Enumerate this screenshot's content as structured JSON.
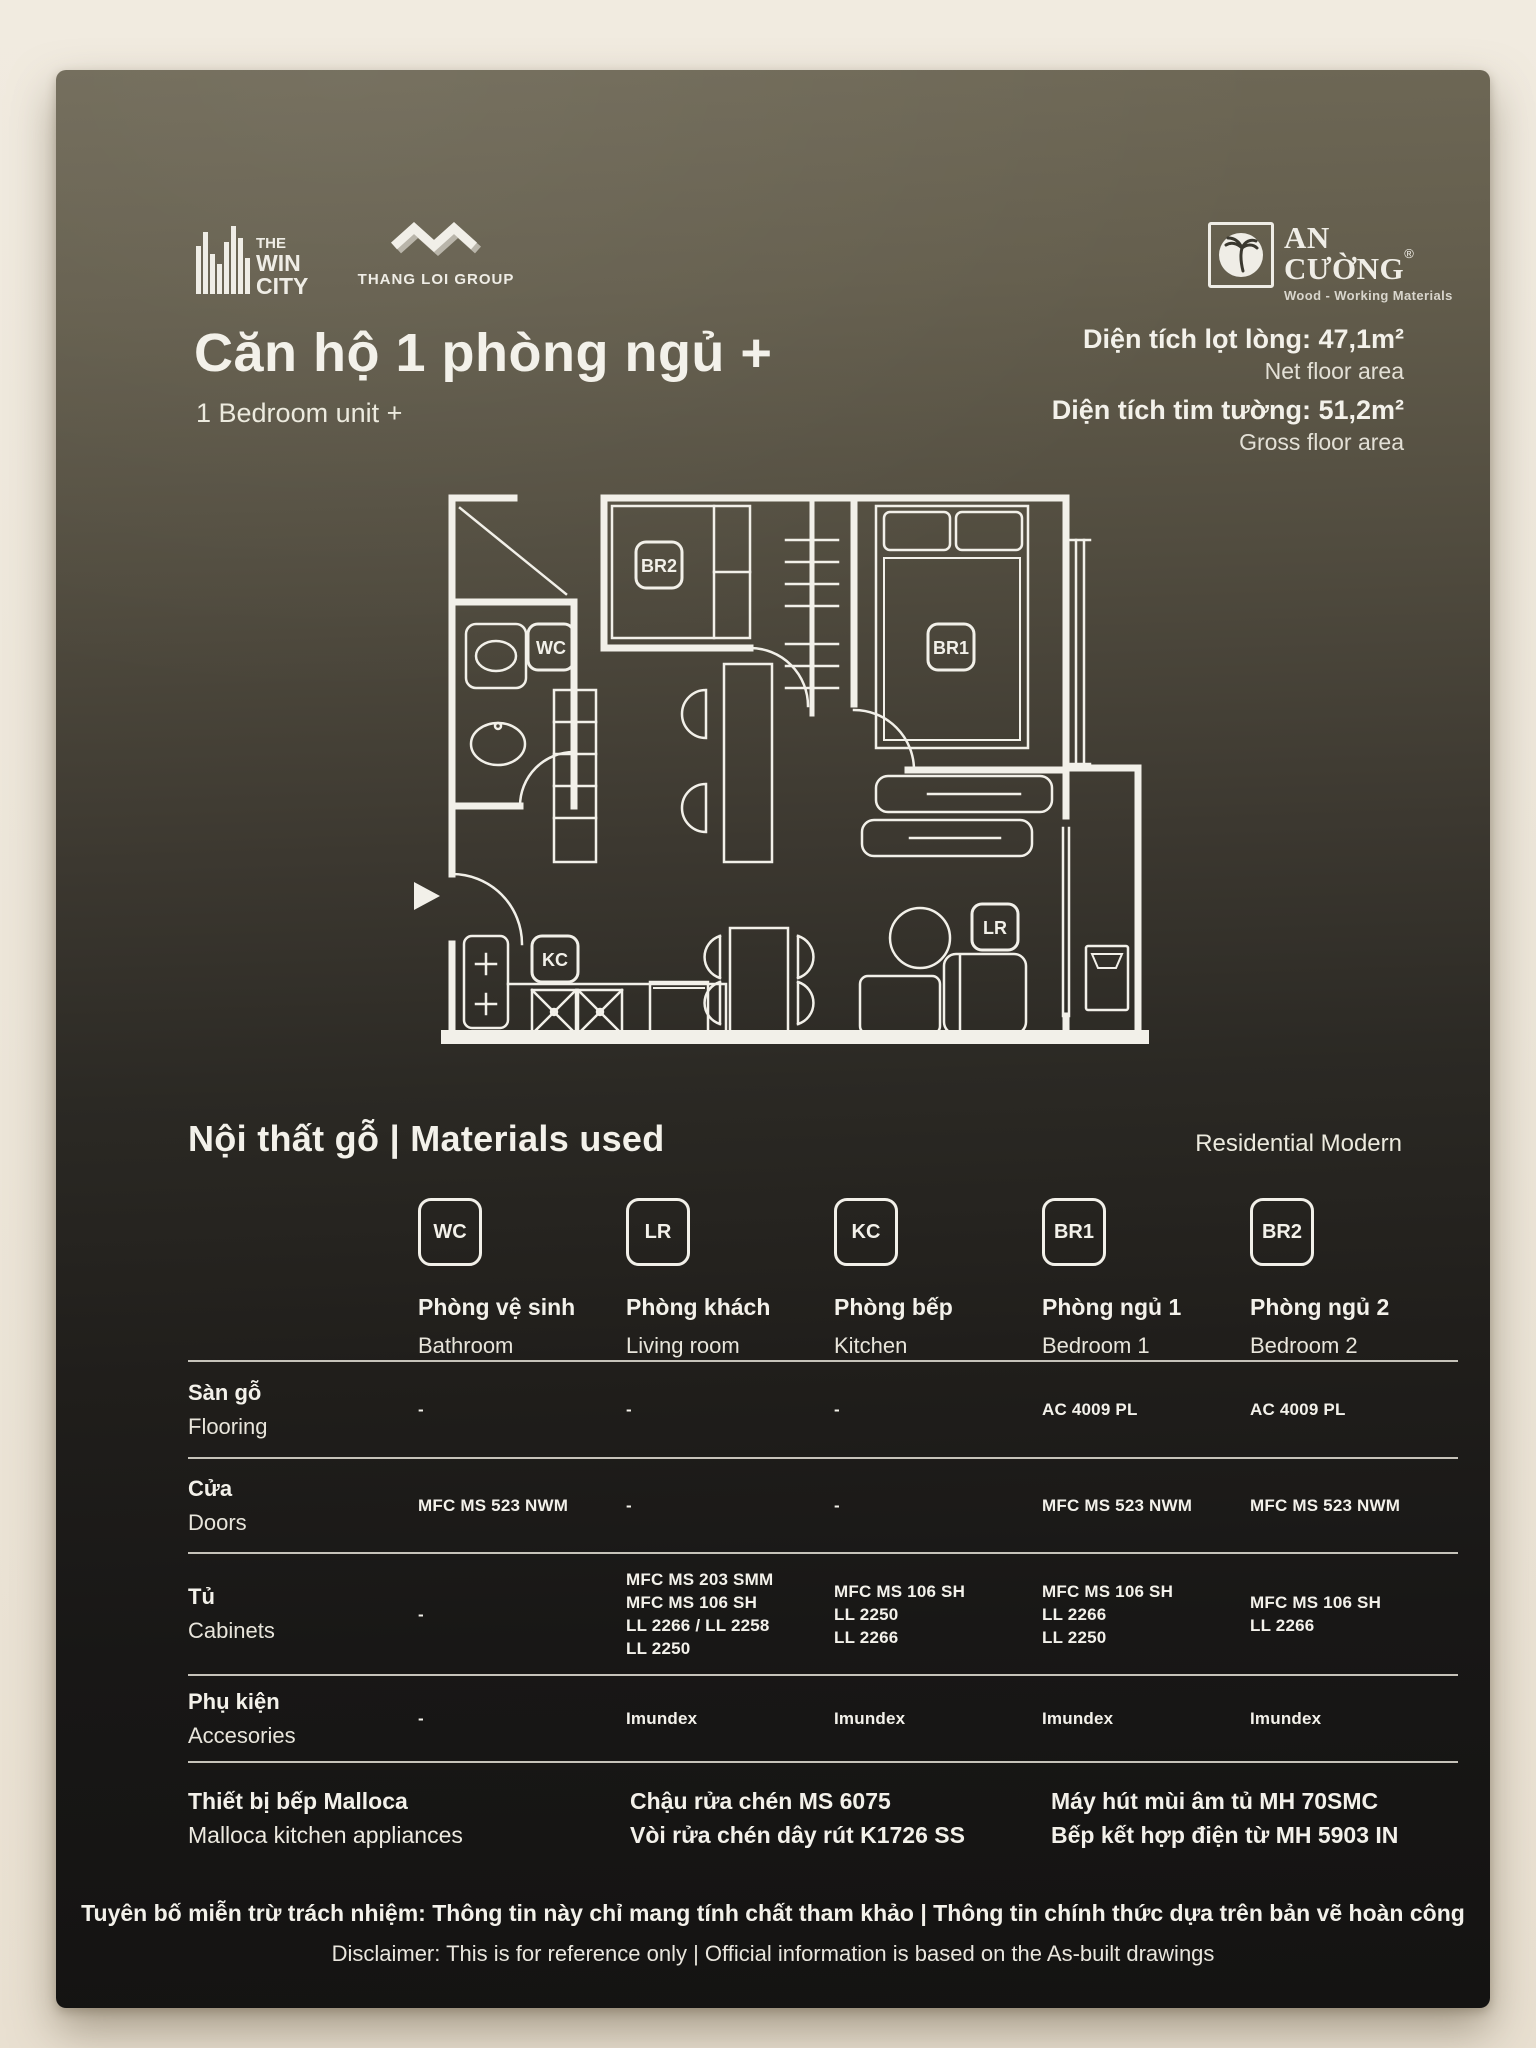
{
  "brands": {
    "win_city": {
      "line1": "THE",
      "line2": "WIN",
      "line3": "CITY"
    },
    "thang_loi": {
      "name": "THANG LOI GROUP"
    },
    "an_cuong": {
      "name": "AN CƯỜNG",
      "reg": "®",
      "tagline": "Wood - Working Materials"
    }
  },
  "header": {
    "title": "Căn hộ 1 phòng ngủ +",
    "subtitle": "1 Bedroom unit +",
    "area_net_label": "Diện tích lọt lòng: 47,1m²",
    "area_net_sub": "Net floor area",
    "area_gross_label": "Diện tích tim tường: 51,2m²",
    "area_gross_sub": "Gross floor area"
  },
  "floorplan": {
    "labels": {
      "wc": "WC",
      "br1": "BR1",
      "br2": "BR2",
      "kc": "KC",
      "lr": "LR"
    }
  },
  "materials": {
    "section_title": "Nội thất gỗ | Materials used",
    "style_note": "Residential Modern",
    "columns": [
      {
        "code": "WC",
        "vi": "Phòng vệ sinh",
        "en": "Bathroom"
      },
      {
        "code": "LR",
        "vi": "Phòng khách",
        "en": "Living room"
      },
      {
        "code": "KC",
        "vi": "Phòng bếp",
        "en": "Kitchen"
      },
      {
        "code": "BR1",
        "vi": "Phòng ngủ 1",
        "en": "Bedroom 1"
      },
      {
        "code": "BR2",
        "vi": "Phòng ngủ 2",
        "en": "Bedroom 2"
      }
    ],
    "rows": [
      {
        "vi": "Sàn gỗ",
        "en": "Flooring",
        "values": [
          "-",
          "-",
          "-",
          "AC 4009 PL",
          "AC 4009 PL"
        ]
      },
      {
        "vi": "Cửa",
        "en": "Doors",
        "values": [
          "MFC MS 523 NWM",
          "-",
          "-",
          "MFC MS 523 NWM",
          "MFC MS 523 NWM"
        ]
      },
      {
        "vi": "Tủ",
        "en": "Cabinets",
        "values": [
          "-",
          "MFC MS 203 SMM\nMFC MS 106 SH\nLL 2266 / LL 2258\nLL 2250",
          "MFC MS 106 SH\nLL 2250\nLL 2266",
          "MFC MS 106 SH\nLL 2266\nLL 2250",
          "MFC MS 106 SH\nLL 2266"
        ]
      },
      {
        "vi": "Phụ kiện",
        "en": "Accesories",
        "values": [
          "-",
          "Imundex",
          "Imundex",
          "Imundex",
          "Imundex"
        ]
      }
    ]
  },
  "appliances": {
    "col1_vi": "Thiết bị bếp Malloca",
    "col1_en": "Malloca kitchen appliances",
    "col2_line1": "Chậu rửa chén MS 6075",
    "col2_line2": "Vòi rửa chén dây rút K1726 SS",
    "col3_line1": "Máy hút mùi âm tủ MH 70SMC",
    "col3_line2": "Bếp kết hợp điện từ MH 5903 IN"
  },
  "disclaimer": {
    "vi": "Tuyên bố miễn trừ trách nhiệm: Thông tin này chỉ mang tính chất tham khảo | Thông tin chính thức dựa trên bản vẽ hoàn công",
    "en": "Disclaimer: This is for reference only | Official information is based on the As-built drawings"
  }
}
